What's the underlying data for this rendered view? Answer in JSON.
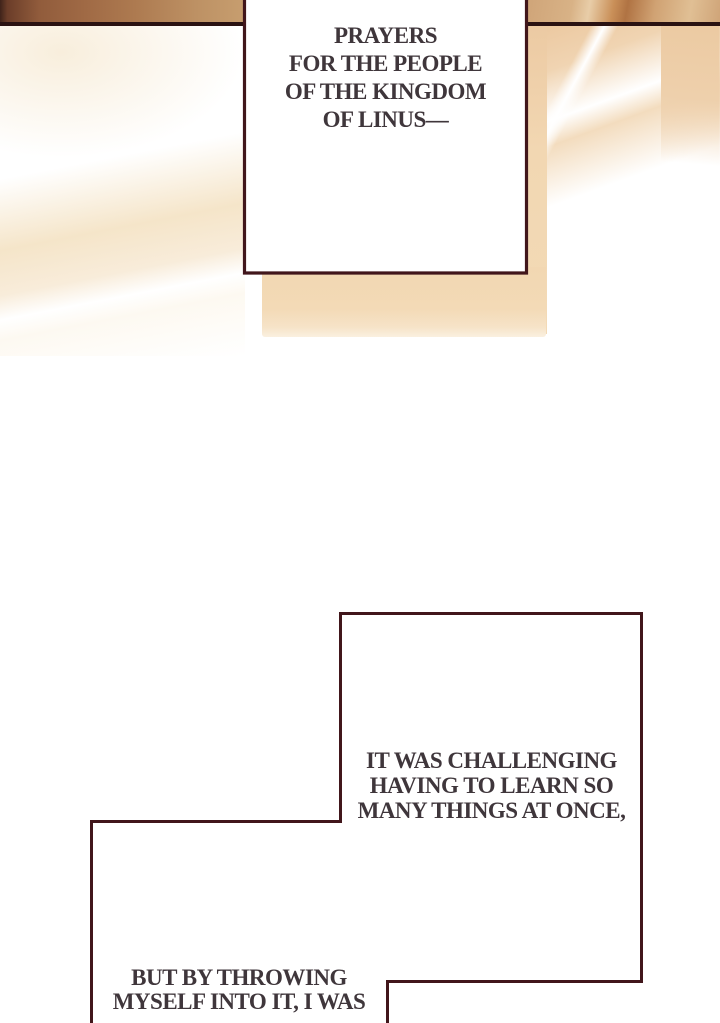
{
  "page": {
    "type": "webtoon-comic-panel"
  },
  "bubbles": [
    {
      "id": "bubble-top",
      "text": "PRAYERS\nFOR THE PEOPLE\nOF THE KINGDOM\nOF LINUS—"
    },
    {
      "id": "bubble-middle",
      "text": "IT WAS CHALLENGING\nHAVING TO LEARN SO\nMANY THINGS AT ONCE,"
    },
    {
      "id": "bubble-bottom",
      "text": "BUT BY THROWING\nMYSELF INTO IT, I WAS"
    }
  ],
  "colors": {
    "page_bg": "#ffffff",
    "text": "#3f363b",
    "bubble_border": "#41161b",
    "bubble_fill": "#ffffff",
    "rule": "#2a1212",
    "band_brown": "#a06a45",
    "band_tan": "#cfa478",
    "tan_light": "#f2d7b2",
    "cream": "#f5e5c9"
  }
}
